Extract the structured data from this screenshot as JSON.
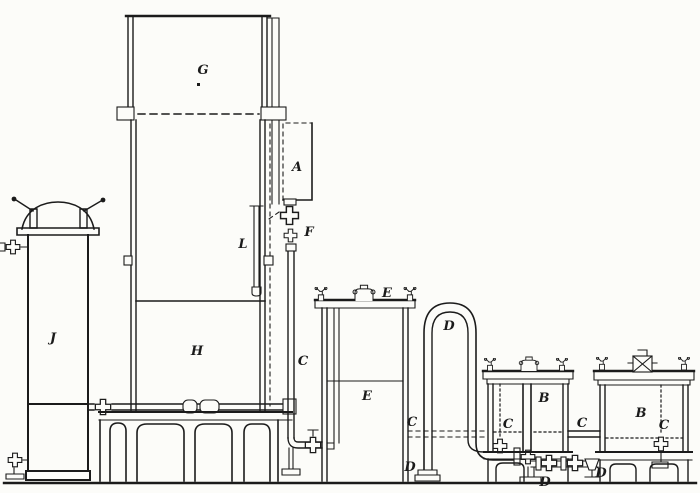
{
  "figure": {
    "kind": "engraved-apparatus-diagram",
    "paper_color": "#fcfcf9",
    "ink_color": "#1b1b1b",
    "labels": [
      {
        "id": "label-g-gasholder",
        "text": "G",
        "x": 203,
        "y": 74
      },
      {
        "id": "label-a-side-box",
        "text": "A",
        "x": 297,
        "y": 171
      },
      {
        "id": "label-f-valve",
        "text": "F",
        "x": 309,
        "y": 236
      },
      {
        "id": "label-l-tube",
        "text": "L",
        "x": 243,
        "y": 248
      },
      {
        "id": "label-j-vessel",
        "text": "J",
        "x": 53,
        "y": 342
      },
      {
        "id": "label-h-inner-tank",
        "text": "H",
        "x": 197,
        "y": 355
      },
      {
        "id": "label-c-downpipe",
        "text": "C",
        "x": 303,
        "y": 365
      },
      {
        "id": "label-e-lid",
        "text": "E",
        "x": 387,
        "y": 297
      },
      {
        "id": "label-e-tank",
        "text": "E",
        "x": 367,
        "y": 400
      },
      {
        "id": "label-d-upipe-top",
        "text": "D",
        "x": 449,
        "y": 330
      },
      {
        "id": "label-c-left-of-upipe",
        "text": "C",
        "x": 412,
        "y": 426
      },
      {
        "id": "label-d-upipe-foot",
        "text": "D",
        "x": 410,
        "y": 471
      },
      {
        "id": "label-c-inside-left-b",
        "text": "C",
        "x": 508,
        "y": 428
      },
      {
        "id": "label-b-left-vessel",
        "text": "B",
        "x": 544,
        "y": 402
      },
      {
        "id": "label-c-between-b",
        "text": "C",
        "x": 582,
        "y": 427
      },
      {
        "id": "label-b-right-vessel",
        "text": "B",
        "x": 641,
        "y": 417
      },
      {
        "id": "label-c-inside-right-b",
        "text": "C",
        "x": 664,
        "y": 429
      },
      {
        "id": "label-d-bottom-center",
        "text": "D",
        "x": 545,
        "y": 486
      },
      {
        "id": "label-d-bottom-valves",
        "text": "D",
        "x": 601,
        "y": 477
      }
    ]
  }
}
